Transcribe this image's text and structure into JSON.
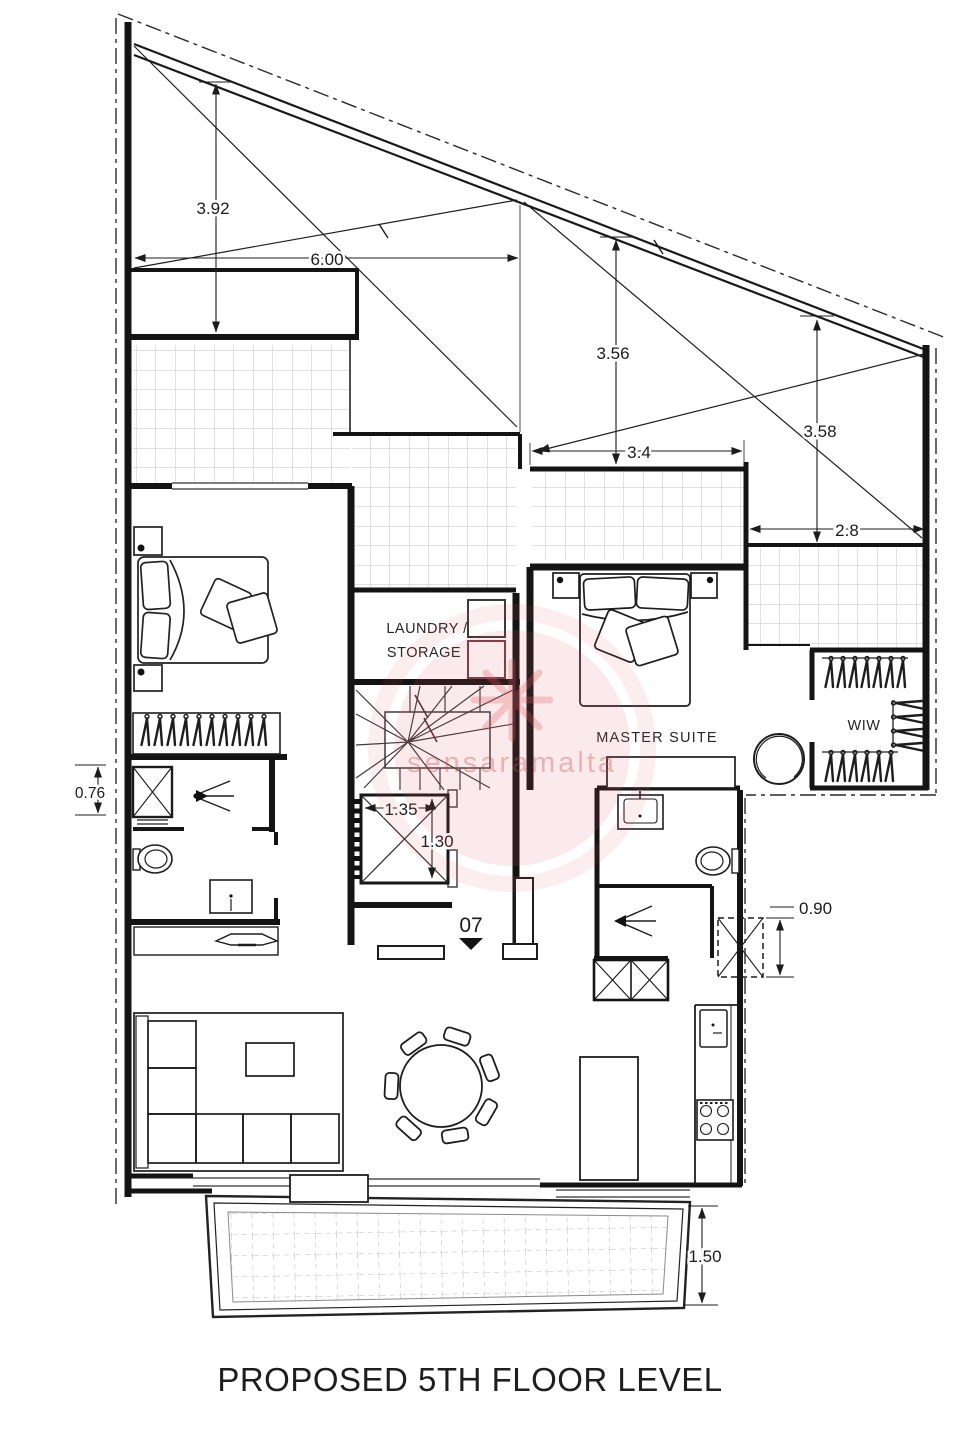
{
  "page": {
    "title": "PROPOSED 5TH FLOOR LEVEL"
  },
  "watermark": {
    "text": "sensaramalta"
  },
  "unit": {
    "number": "07"
  },
  "rooms": {
    "laundry_line1": "LAUNDRY /",
    "laundry_line2": "STORAGE",
    "master_suite": "MASTER SUITE",
    "walk_in_wardrobe": "WIW"
  },
  "dimensions": {
    "left_void_height": "3.92",
    "left_void_width": "6.00",
    "center_void_height": "3.56",
    "center_terrace_width": "3.4",
    "right_void_height": "3.58",
    "right_terrace_width": "2.8",
    "shower_width": "0.76",
    "lift_width": "1.35",
    "lift_depth": "1.30",
    "shaft_width": "0.90",
    "rear_terrace_depth": "1.50"
  }
}
